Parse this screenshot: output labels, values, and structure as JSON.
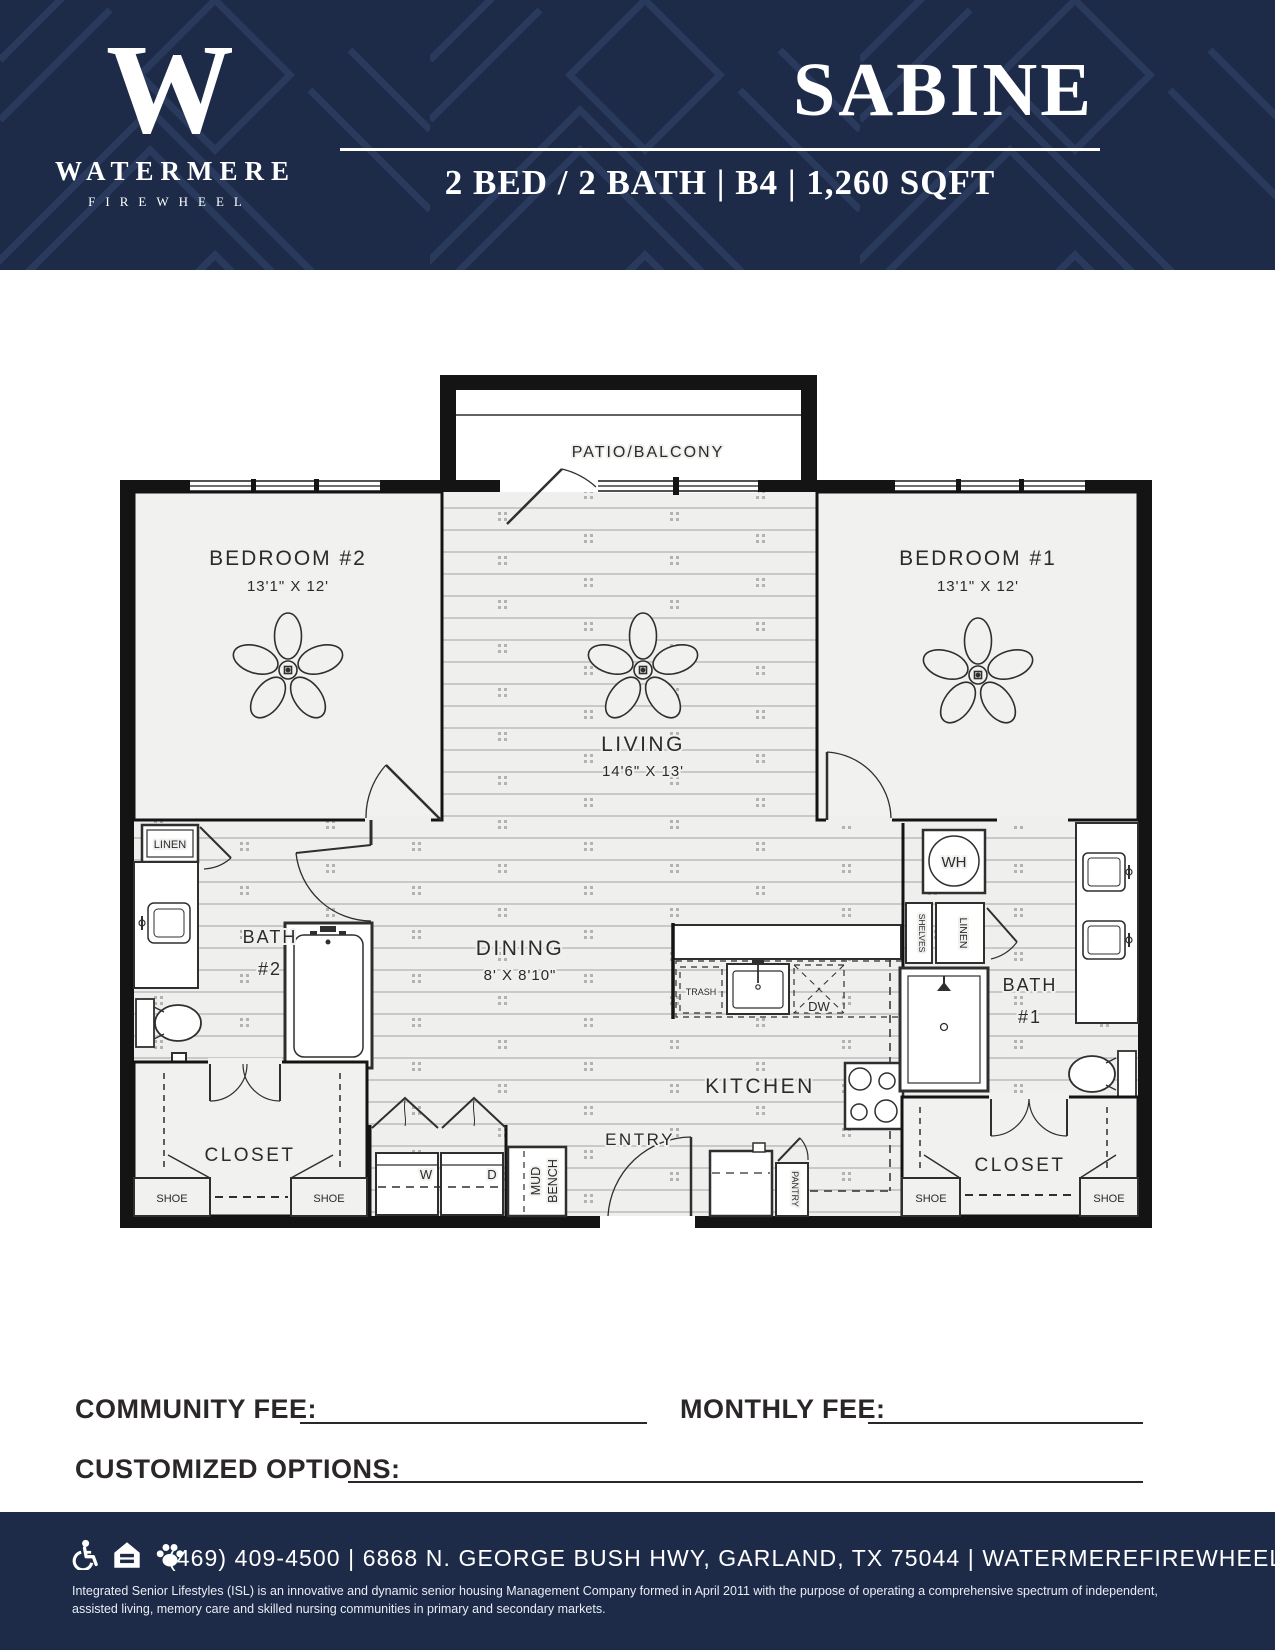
{
  "theme": {
    "navy": "#1d2b49",
    "pattern_line": "#2a3a5c",
    "ink": "#2b2627",
    "plan_wall": "#141414",
    "room_fill": "#f1f1ef"
  },
  "header": {
    "monogram": "W",
    "brand_name": "WATERMERE",
    "brand_sub": "FIREWHEEL",
    "plan_name": "SABINE",
    "plan_specs": "2 BED / 2 BATH | B4 | 1,260 SQFT"
  },
  "floorplan": {
    "patio": "PATIO/BALCONY",
    "bedroom2": {
      "name": "BEDROOM #2",
      "dims": "13'1\" X 12'"
    },
    "bedroom1": {
      "name": "BEDROOM #1",
      "dims": "13'1\" X 12'"
    },
    "living": {
      "name": "LIVING",
      "dims": "14'6\" X 13'"
    },
    "dining": {
      "name": "DINING",
      "dims": "8' X 8'10\""
    },
    "kitchen": "KITCHEN",
    "entry": "ENTRY",
    "bath2": {
      "line1": "BATH",
      "line2": "#2"
    },
    "bath1": {
      "line1": "BATH",
      "line2": "#1"
    },
    "closet": "CLOSET",
    "linen": "LINEN",
    "shelves": "SHELVES",
    "water_heater": "WH",
    "trash": "TRASH",
    "dishwasher": "DW",
    "pantry": "PANTRY",
    "mud": "MUD",
    "bench": "BENCH",
    "washer": "W",
    "dryer": "D",
    "shoe": "SHOE"
  },
  "fees": {
    "community_label": "COMMUNITY FEE:",
    "monthly_label": "MONTHLY FEE:",
    "customized_label": "CUSTOMIZED OPTIONS:"
  },
  "footer": {
    "icons": [
      "wheelchair-icon",
      "equal-housing-icon",
      "paw-icon"
    ],
    "contact_line": "(469) 409-4500 | 6868 N. GEORGE BUSH HWY, GARLAND, TX 75044 | WATERMEREFIREWHEEL.COM",
    "disclaimer": "Integrated Senior Lifestyles (ISL) is an innovative and dynamic senior housing Management Company formed in April 2011 with the purpose of operating a comprehensive spectrum of independent, assisted living, memory care and skilled nursing communities in primary and secondary markets."
  }
}
